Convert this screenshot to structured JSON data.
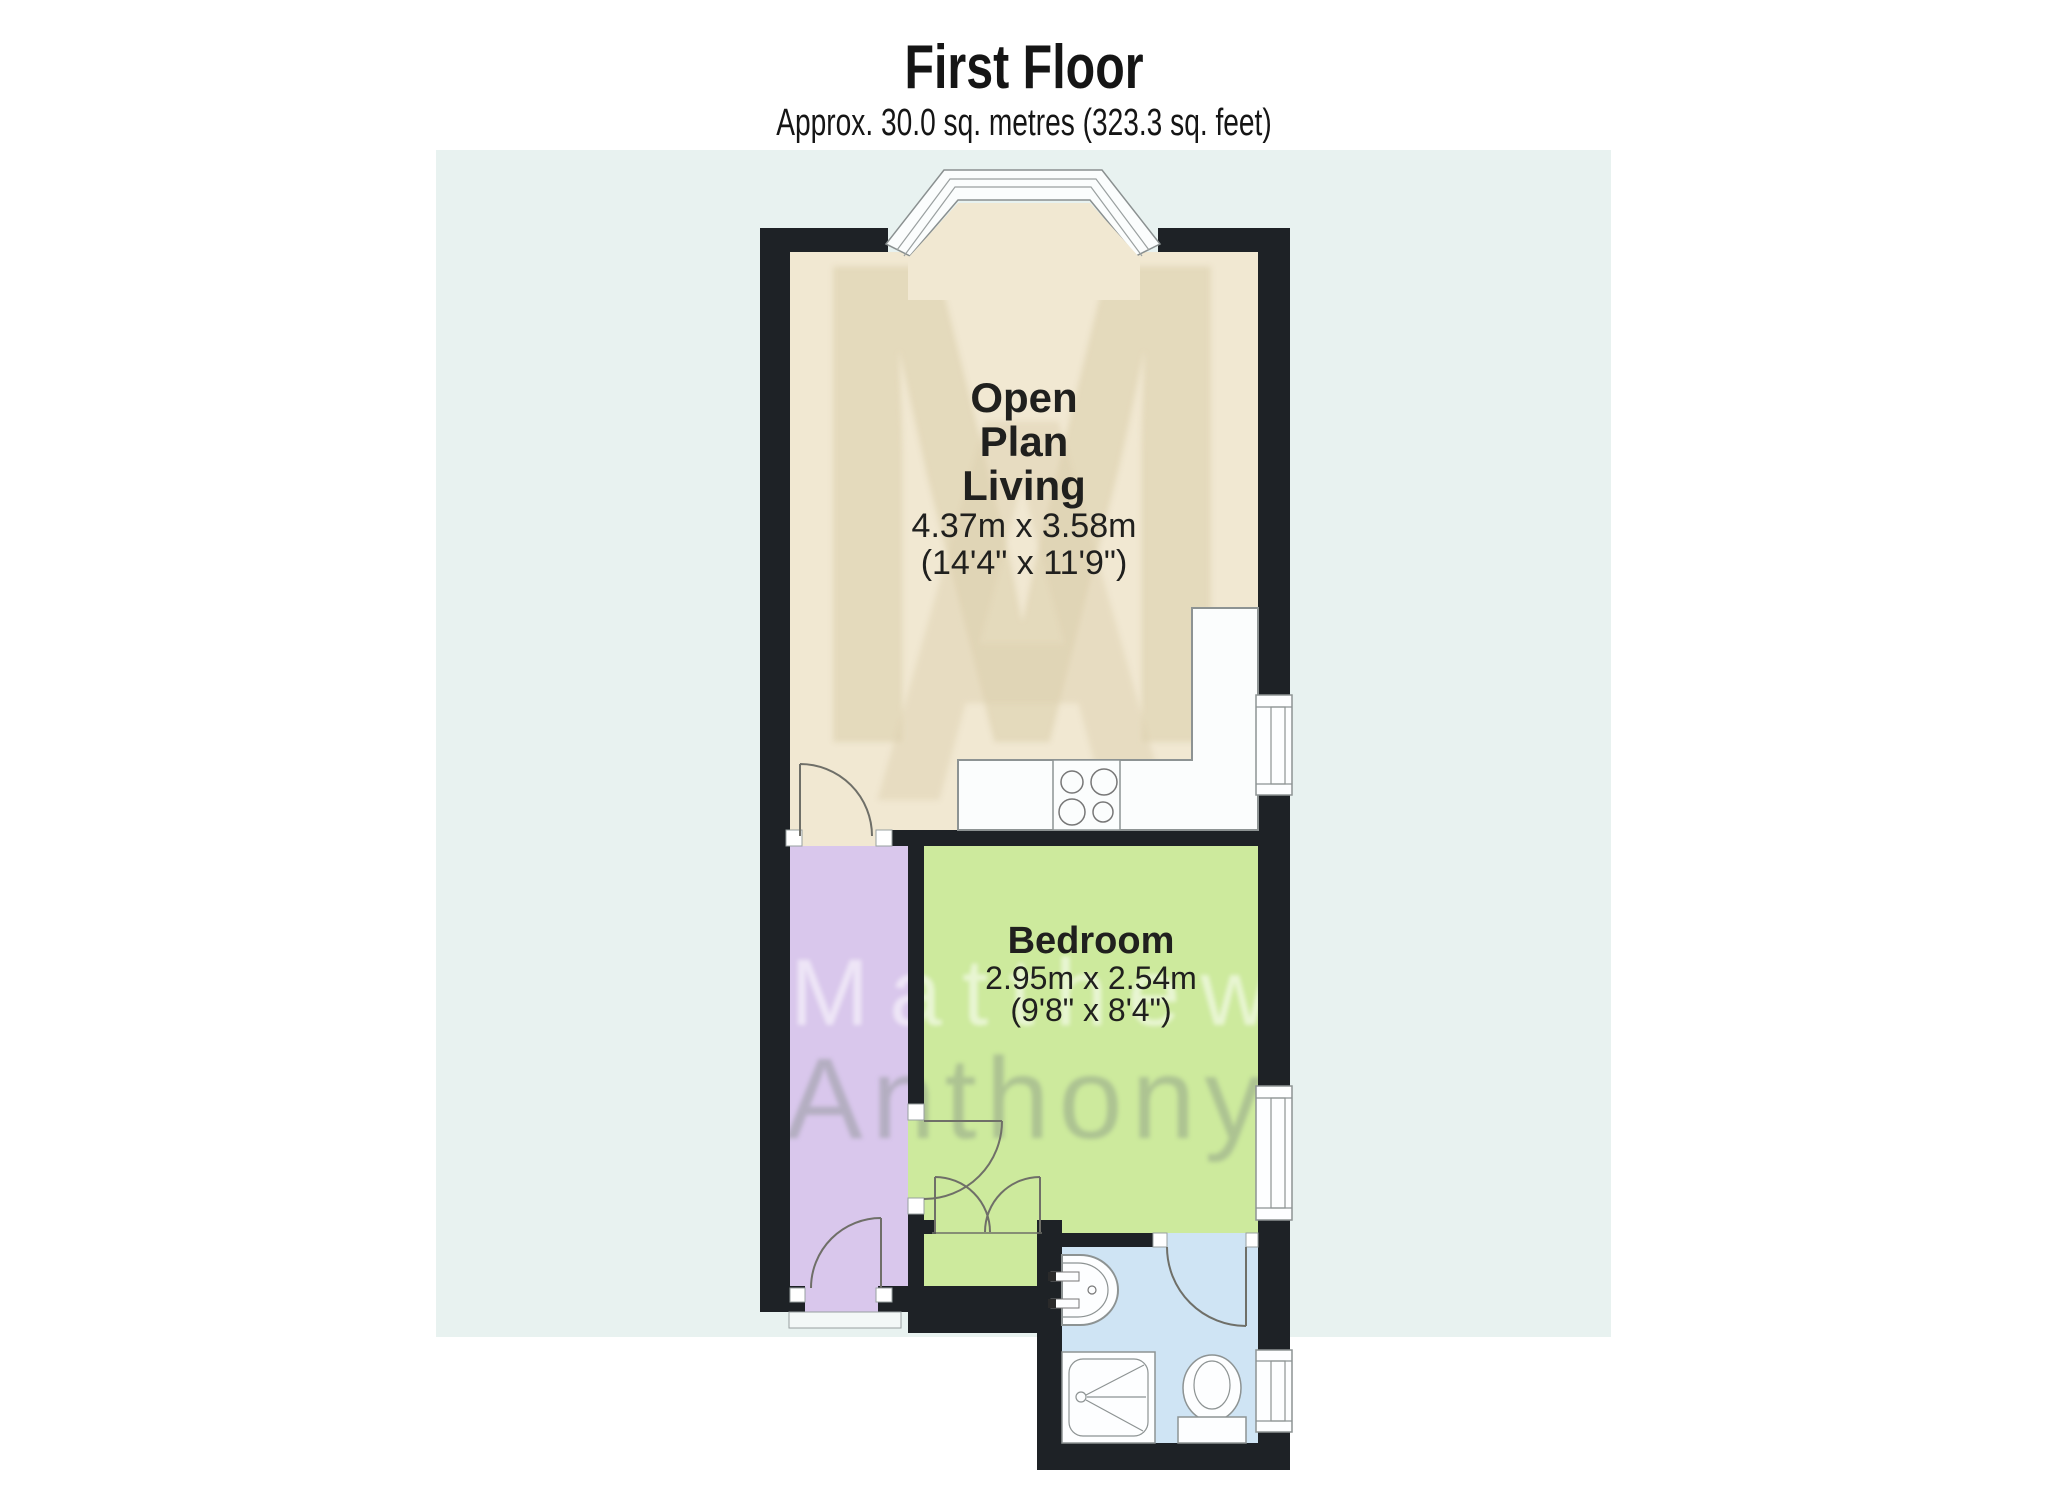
{
  "header": {
    "title": "First Floor",
    "subtitle": "Approx. 30.0 sq. metres (323.3 sq. feet)"
  },
  "rooms": {
    "living": {
      "name_line1": "Open",
      "name_line2": "Plan",
      "name_line3": "Living",
      "dim_metric": "4.37m x 3.58m",
      "dim_imperial": "(14'4\" x 11'9\")"
    },
    "bedroom": {
      "name": "Bedroom",
      "dim_metric": "2.95m x 2.54m",
      "dim_imperial": "(9'8\" x 8'4\")"
    }
  },
  "watermark": {
    "monogram_m": "M",
    "monogram_a": "A",
    "line1": "Matthew",
    "line2": "Anthony"
  },
  "legend_colors": {
    "living_room": "#f1e8d2",
    "bedroom": "#cdea9d",
    "hallway": "#d9c7ec",
    "bathroom": "#cfe4f4",
    "wall": "#1e2226",
    "background_panel": "#e8f2f0"
  }
}
